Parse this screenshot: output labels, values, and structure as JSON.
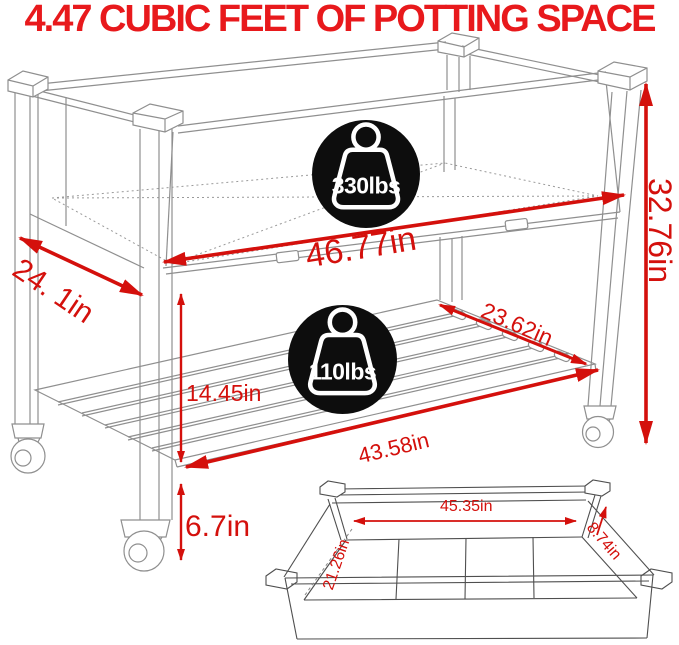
{
  "title": "4.47 CUBIC FEET OF POTTING SPACE",
  "colors": {
    "title_red": "#e8191c",
    "dimension_red": "#d4100c",
    "badge_black": "#0d0d0d",
    "line_gray": "#8f8f8f"
  },
  "capacity_badges": [
    {
      "icon": "weight-icon",
      "label": "330lbs",
      "location": "top-bin"
    },
    {
      "icon": "weight-icon",
      "label": "110lbs",
      "location": "bottom-shelf"
    }
  ],
  "dimensions": {
    "top_depth": "24. 1in",
    "top_width": "46.77in",
    "overall_height": "32.76in",
    "shelf_depth": "23.62in",
    "bin_to_shelf_height": "14.45in",
    "shelf_width": "43.58in",
    "ground_clearance": "6.7in"
  },
  "inset_box": {
    "inner_length": "45.35in",
    "inner_width": "21.26in",
    "inner_depth": "8.74in"
  }
}
